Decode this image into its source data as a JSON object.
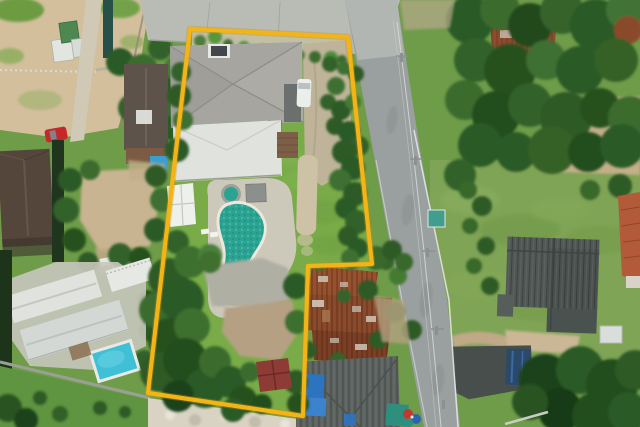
{
  "scene": {
    "type": "aerial-drone-photograph",
    "description": "Top-down aerial photo of a land plot for sale outlined with a yellow boundary: a large grey hip-roof house with a kidney-shaped teal swimming pool, lawn and dense garden trees; an asphalt road runs diagonally on the right, rusty corrugated shop-house roofs sit in a notch of the boundary at bottom centre, a neighbouring villa with a blue pool lies bottom-left, and green fields with a dark barn lie east of the road.",
    "features": [
      "yellow-property-boundary",
      "grey-hip-roof-house-with-solar-panel",
      "kidney-shaped-teal-pool-with-spa",
      "white-van-and-carport",
      "lawn-with-footpath",
      "rusty-corrugated-shophouse-roofs",
      "blue-tarp-patched-roof",
      "neighbour-villa-with-blue-pool",
      "asphalt-road-with-utility-wires",
      "dark-grey-barn-in-field",
      "sandy-vacant-lot-top-left",
      "red-parked-car",
      "dense-tropical-trees"
    ]
  },
  "colors": {
    "boundary_yellow": "#f2b416",
    "asphalt": "#9aa0a0",
    "concrete": "#b8bcb4",
    "sand": "#d3bf9c",
    "lawn_green": "#79ab48",
    "field_green": "#7fa455",
    "tree_dark": "#2c5a25",
    "tree_mid": "#3a6c2d",
    "tree_light": "#49803a",
    "pool_teal": "#2aa392",
    "pool_coping": "#ece8dc",
    "roof_main_gray": "#a6a5a0",
    "roof_white": "#e0e2dd",
    "rust": "#8a4a2c",
    "roof_dark": "#5c625f",
    "roof_brown": "#5d534b",
    "left_pool_blue": "#3fc0d6",
    "tarp_blue": "#2d74c0",
    "shed_red": "#8e3b36",
    "dirt": "#c9b491",
    "barn_gray": "#505855",
    "tile_orange": "#b25a3a",
    "van_white": "#eceeec",
    "car_red": "#c5272b",
    "rubble": "#d9d3c4",
    "navy_tarp": "#2b4a6b",
    "tarp_green": "#2f8f7e",
    "wire_gray": "#d7dbd9",
    "deck_gray": "#ccc8ba"
  }
}
